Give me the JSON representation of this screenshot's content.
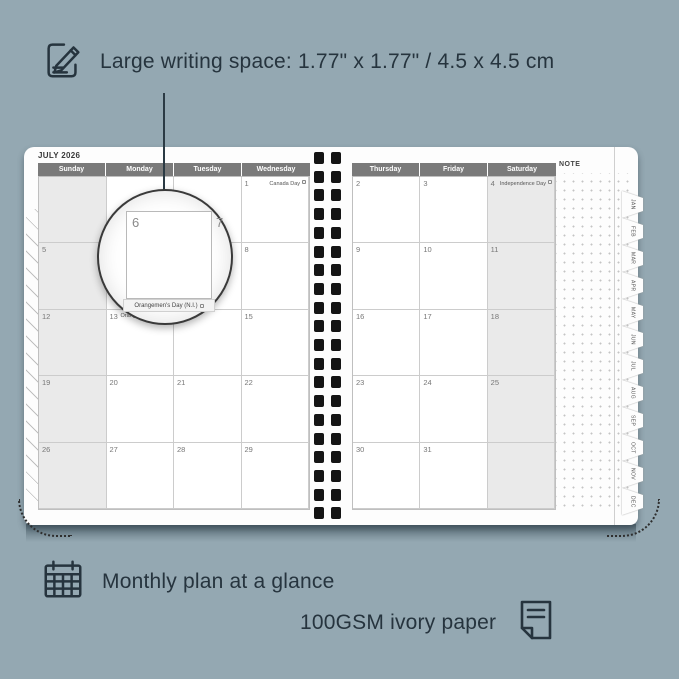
{
  "colors": {
    "background": "#94a8b2",
    "text": "#26343e",
    "header_bar": "#7a7a7a",
    "weekend_shade": "#eaeaea",
    "callout_line": "#2b3a44"
  },
  "features": {
    "writing_space": {
      "icon": "pencil-note-icon",
      "text": "Large writing space: 1.77\" x 1.77\" / 4.5 x 4.5 cm"
    },
    "monthly_plan": {
      "icon": "calendar-grid-icon",
      "text": "Monthly plan at a glance"
    },
    "paper": {
      "icon": "paper-sheet-icon",
      "text": "100GSM ivory paper"
    }
  },
  "planner": {
    "month_title": "JULY 2026",
    "note_label": "NOTE",
    "left_day_headers": [
      "Sunday",
      "Monday",
      "Tuesday",
      "Wednesday"
    ],
    "right_day_headers": [
      "Thursday",
      "Friday",
      "Saturday"
    ],
    "left_rows": [
      [
        "",
        "",
        "",
        "1"
      ],
      [
        "5",
        "6",
        "7",
        "8"
      ],
      [
        "12",
        "13",
        "14",
        "15"
      ],
      [
        "19",
        "20",
        "21",
        "22"
      ],
      [
        "26",
        "27",
        "28",
        "29"
      ]
    ],
    "right_rows": [
      [
        "2",
        "3",
        "4"
      ],
      [
        "9",
        "10",
        "11"
      ],
      [
        "16",
        "17",
        "18"
      ],
      [
        "23",
        "24",
        "25"
      ],
      [
        "30",
        "31",
        ""
      ]
    ],
    "holidays": {
      "1": {
        "name": "Canada Day",
        "align": "right"
      },
      "4": {
        "name": "Independence Day",
        "align": "right"
      },
      "13": {
        "name": "Orangemen's Day (N.I.)",
        "align": "left"
      }
    },
    "month_tabs": [
      "JAN",
      "FEB",
      "MAR",
      "APR",
      "MAY",
      "JUN",
      "JUL",
      "AUG",
      "SEP",
      "OCT",
      "NOV",
      "DEC"
    ]
  },
  "magnifier": {
    "day_left": "6",
    "day_right": "7",
    "holiday_text": "Orangemen's Day (N.I.)"
  }
}
